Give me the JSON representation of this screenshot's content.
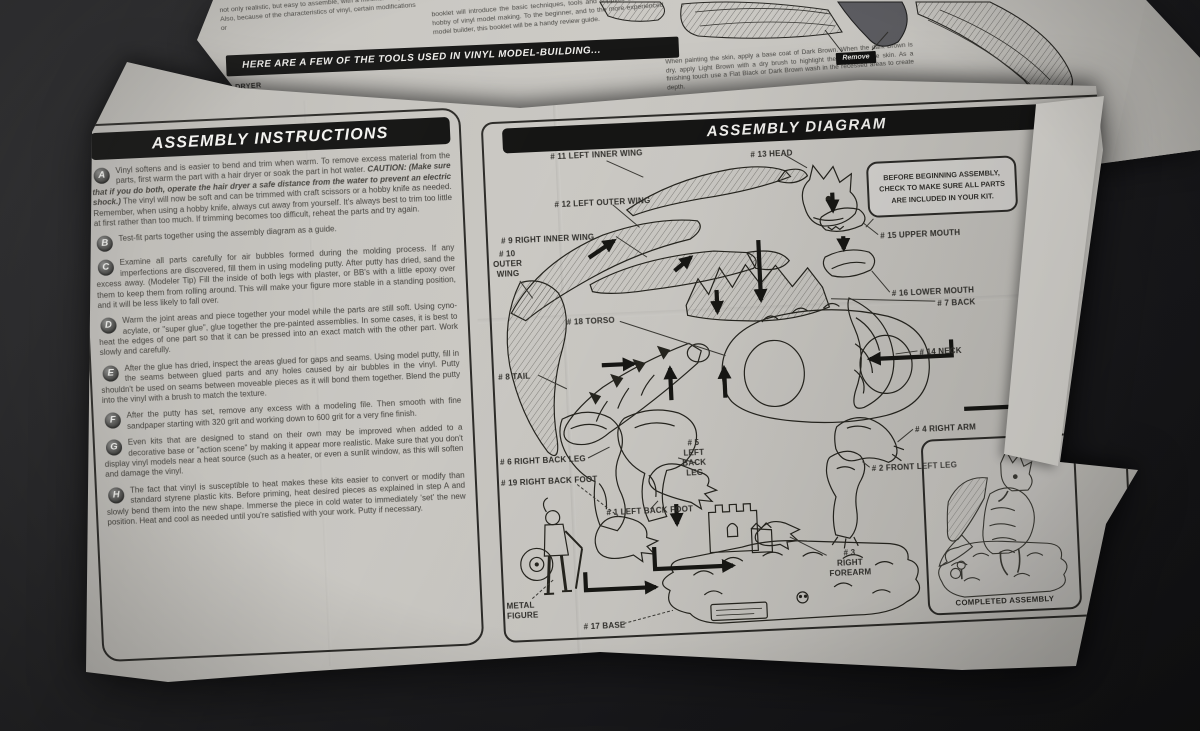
{
  "under_sheet": {
    "intro_left": "not only realistic, but easy to assemble, with a minimum of parts. Also, because of the characteristics of vinyl, certain modifications or",
    "intro_right": "booklet will introduce the basic techniques, tools and supplies used in the hobby of vinyl model making. To the beginner, and to the more experienced model builder, this booklet will be a handy review guide.",
    "tools_banner": "HERE ARE A FEW OF THE TOOLS USED IN VINYL MODEL-BUILDING...",
    "hair_dryer_label": "HAIR DRYER",
    "painting_note": "When painting the skin, apply a base coat of Dark Brown. When the dark Brown is dry, apply Light Brown with a dry brush to highlight the details of the skin. As a finishing touch use a Flat Black or Dark Brown wash in the recessed areas to create depth.",
    "remove_label": "Remove",
    "dry_brush_note": "Use a dry brush with the"
  },
  "instructions": {
    "title": "ASSEMBLY INSTRUCTIONS",
    "steps": [
      {
        "letter": "A",
        "text_before": "Vinyl softens and is easier to bend and trim when warm. To remove excess material from the parts, first warm the part with a hair dryer or soak the part in hot water. ",
        "caution": "CAUTION: (Make sure that if you do both, operate the hair dryer a safe distance from the water to prevent an electric shock.)",
        "text_after": " The vinyl will now be soft and can be trimmed with craft scissors or a hobby knife as needed. Remember, when using a hobby knife, always cut away from yourself. It's always best to trim too little at first rather than too much. If trimming becomes too difficult, reheat the parts and try again."
      },
      {
        "letter": "B",
        "text": "Test-fit parts together using the assembly diagram as a guide."
      },
      {
        "letter": "C",
        "text": "Examine all parts carefully for air bubbles formed during the molding process. If any imperfections are discovered, fill them in using modeling putty. After putty has dried, sand the excess away. (Modeler Tip) Fill the inside of both legs with plaster, or BB's with a little epoxy over them to keep them from rolling around. This will make your figure more stable in a standing position, and it will be less likely to fall over."
      },
      {
        "letter": "D",
        "text": "Warm the joint areas and piece together your model while the parts are still soft. Using cyno-acylate, or \"super glue\", glue together the pre-painted assemblies. In some cases, it is best to heat the edges of one part so that it can be pressed into an exact match with the other part. Work slowly and carefully."
      },
      {
        "letter": "E",
        "text": "After the glue has dried, inspect the areas glued for gaps and seams. Using model putty, fill in the seams between glued parts and any holes caused by air bubbles in the vinyl. Putty shouldn't be used on seams between moveable pieces as it will bond them together. Blend the putty into the vinyl with a brush to match the texture."
      },
      {
        "letter": "F",
        "text": "After the putty has set, remove any excess with a modeling file. Then smooth with fine sandpaper starting with 320 grit and working down to 600 grit for a very fine finish."
      },
      {
        "letter": "G",
        "text": "Even kits that are designed to stand on their own may be improved when added to a decorative base or \"action scene\" by making it appear more realistic. Make sure that you don't display vinyl models near a heat source (such as a heater, or even a sunlit window, as this will soften and damage the vinyl."
      },
      {
        "letter": "H",
        "text": "The fact that vinyl is susceptible to heat makes these kits easier to convert or modify than standard styrene plastic kits. Before priming, heat desired pieces as explained in step A and slowly bend them into the new shape. Immerse the piece in cold water to immediately 'set' the new position. Heat and cool as needed until you're satisfied with your work. Putty if necessary."
      }
    ]
  },
  "diagram": {
    "title": "ASSEMBLY DIAGRAM",
    "note": "BEFORE BEGINNING ASSEMBLY,\nCHECK TO MAKE SURE ALL PARTS\nARE INCLUDED IN YOUR KIT.",
    "completed_label": "COMPLETED ASSEMBLY",
    "labels": {
      "p11": "# 11 LEFT INNER WING",
      "p13": "# 13 HEAD",
      "p12": "# 12 LEFT OUTER WING",
      "p9": "# 9 RIGHT INNER WING",
      "p10": "# 10\nOUTER\nWING",
      "p15": "# 15 UPPER MOUTH",
      "p16": "# 16 LOWER MOUTH",
      "p7": "# 7 BACK",
      "p18": "# 18 TORSO",
      "p14": "# 14 NECK",
      "p8": "# 8 TAIL",
      "p4": "# 4 RIGHT ARM",
      "p5": "# 5\nLEFT\nBACK\nLEG",
      "p6": "# 6 RIGHT BACK LEG",
      "p19": "# 19 RIGHT BACK FOOT",
      "p2": "# 2 FRONT LEFT LEG",
      "p1": "# 1 LEFT BACK FOOT",
      "p3": "# 3\nRIGHT\nFOREARM",
      "metal_figure": "METAL\nFIGURE",
      "p17": "# 17 BASE"
    }
  }
}
